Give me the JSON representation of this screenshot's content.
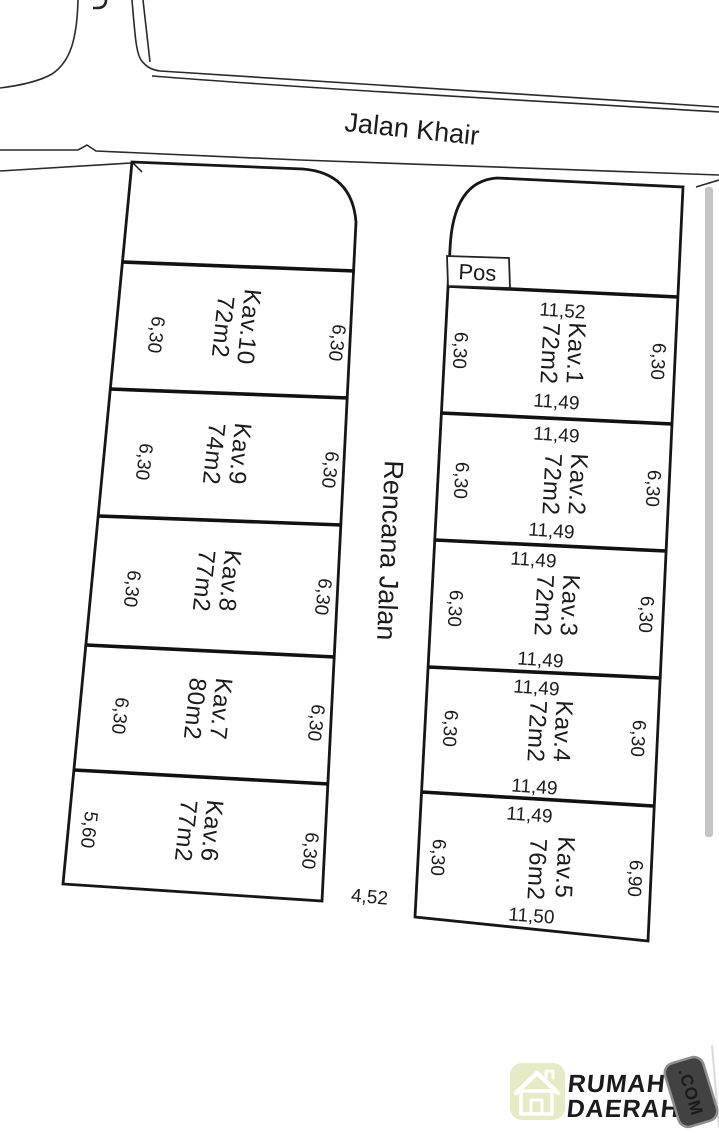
{
  "roads": {
    "top_road_label": "Jalan Khair",
    "middle_road_label": "Rencana Jalan",
    "middle_road_end_width": "4,52"
  },
  "guard_post_label": "Pos",
  "left_block_plots": [
    {
      "name": "Kav.10",
      "area": "72m2",
      "side_left": "6,30",
      "side_right": "6,30"
    },
    {
      "name": "Kav.9",
      "area": "74m2",
      "side_left": "6,30",
      "side_right": "6,30"
    },
    {
      "name": "Kav.8",
      "area": "77m2",
      "side_left": "6,30",
      "side_right": "6,30"
    },
    {
      "name": "Kav.7",
      "area": "80m2",
      "side_left": "6,30",
      "side_right": "6,30"
    },
    {
      "name": "Kav.6",
      "area": "77m2",
      "side_left": "5,60",
      "side_right": "6,30"
    }
  ],
  "right_block_plots": [
    {
      "name": "Kav.1",
      "area": "72m2",
      "top": "11,52",
      "bottom": "11,49",
      "side_left": "6,30",
      "side_right": "6,30"
    },
    {
      "name": "Kav.2",
      "area": "72m2",
      "top": "11,49",
      "bottom": "11,49",
      "side_left": "6,30",
      "side_right": "6,30"
    },
    {
      "name": "Kav.3",
      "area": "72m2",
      "top": "11,49",
      "bottom": "11,49",
      "side_left": "6,30",
      "side_right": "6,30"
    },
    {
      "name": "Kav.4",
      "area": "72m2",
      "top": "11,49",
      "bottom": "11,49",
      "side_left": "6,30",
      "side_right": "6,30"
    },
    {
      "name": "Kav.5",
      "area": "76m2",
      "top": "11,49",
      "bottom": "11,50",
      "side_left": "6,30",
      "side_right": "6,90"
    }
  ],
  "logo": {
    "brand_line1": "RUMAH",
    "brand_line2": "DAERAH",
    "badge": ".COM",
    "colors": {
      "brand1": "#4ba3da",
      "brand2": "#ee8a3d",
      "badge_bg": "#424242",
      "badge_border": "#8f8f8f",
      "badge_text": "#f5f5f5",
      "tile_bg": "#e6eac6",
      "house_stroke": "#ffffff"
    }
  }
}
